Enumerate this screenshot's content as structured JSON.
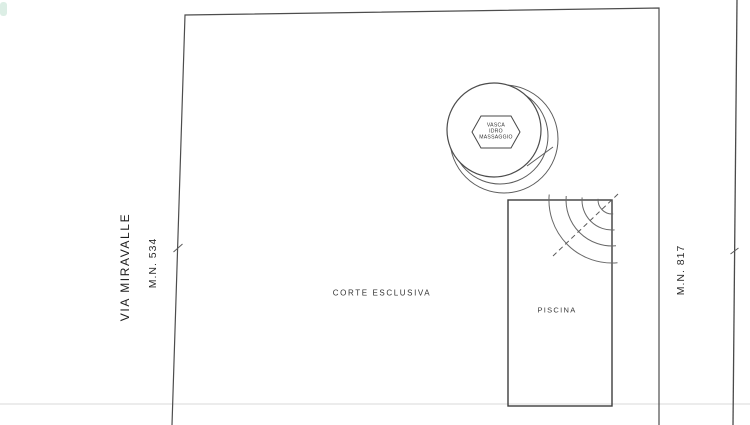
{
  "page": {
    "background_color": "#ffffff",
    "line_color": "#4d4d4d",
    "fold_line_color": "#e6e6e6"
  },
  "plan": {
    "street_label": "VIA MIRAVALLE",
    "parcel_left_label": "M.N. 534",
    "parcel_right_label": "M.N. 817",
    "courtyard_label": "CORTE ESCLUSIVA",
    "pool_label": "PISCINA",
    "hot_tub_label": "VASCA\nIDRO\nMASSAGGIO"
  }
}
